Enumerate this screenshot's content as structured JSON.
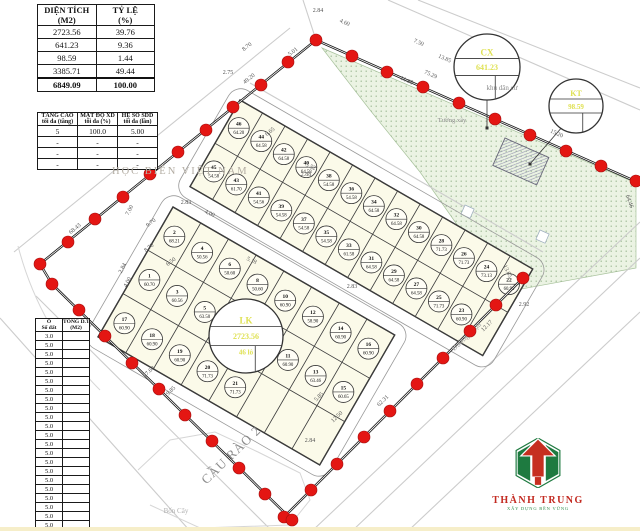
{
  "colors": {
    "dot": "#e41613",
    "dot_edge": "#a50d0d",
    "lot_fill": "#fbfae9",
    "green": "#ebf3e3",
    "green_dot": "#93b289",
    "accent_yellow": "#dfe153",
    "logo_red": "#c62f20",
    "logo_green": "#1e7a40"
  },
  "tables": {
    "area_summary": {
      "headers": [
        [
          "DIỆN TÍCH",
          "(M2)"
        ],
        [
          "TỶ LỆ",
          "(%)"
        ]
      ],
      "rows": [
        [
          "2723.56",
          "39.76"
        ],
        [
          "641.23",
          "9.36"
        ],
        [
          "98.59",
          "1.44"
        ],
        [
          "3385.71",
          "49.44"
        ]
      ],
      "total": [
        "6849.09",
        "100.00"
      ]
    },
    "planning": {
      "headers": [
        [
          "TẦNG CAO",
          "tối đa (tầng)"
        ],
        [
          "MẬT ĐỘ XD",
          "tối đa (%)"
        ],
        [
          "HỆ SỐ SDD",
          "tối đa (lần)"
        ]
      ],
      "rows": [
        [
          "5",
          "100.0",
          "5.00"
        ],
        [
          "-",
          "-",
          "-"
        ],
        [
          "-",
          "-",
          "-"
        ],
        [
          "-",
          "-",
          "-"
        ]
      ]
    },
    "lot_list": {
      "headers": [
        [
          "Ô",
          "Số đất"
        ],
        [
          "TỔNG D.TÍCH",
          "(M2)"
        ]
      ],
      "rows": [
        "3.0",
        "5.0",
        "5.0",
        "5.0",
        "5.0",
        "5.0",
        "5.0",
        "5.0",
        "5.0",
        "5.0",
        "5.0",
        "5.0",
        "5.0",
        "5.0",
        "5.0",
        "5.0",
        "5.0",
        "5.0",
        "5.0",
        "5.0",
        "5.0",
        "5.0"
      ]
    }
  },
  "labels": {
    "campus": "HỌC BIỂN VIỆT NAM"
  },
  "logo": {
    "name": "THÀNH TRUNG",
    "tagline": "XÂY DỰNG BỀN VỮNG"
  },
  "legend_circles": [
    {
      "name": "lk-circle",
      "cx": 246,
      "cy": 336,
      "r": 37,
      "lines": [
        "LK",
        "2723.56",
        "46 lô"
      ],
      "fs": [
        9,
        8,
        7
      ]
    },
    {
      "name": "cx-circle",
      "cx": 487,
      "cy": 67,
      "r": 33,
      "lines": [
        "CX",
        "641.23",
        ""
      ],
      "fs": [
        9,
        8,
        7
      ]
    },
    {
      "name": "kt-circle",
      "cx": 576,
      "cy": 106,
      "r": 27,
      "lines": [
        "KT",
        "98.59",
        ""
      ],
      "fs": [
        8,
        7,
        6
      ]
    }
  ],
  "map": {
    "green_area": [
      [
        322,
        48
      ],
      [
        636,
        183
      ],
      [
        636,
        268
      ],
      [
        505,
        292
      ],
      [
        470,
        243
      ],
      [
        420,
        172
      ],
      [
        370,
        110
      ]
    ],
    "roads": [
      [
        [
          388,
          0
        ],
        [
          640,
          110
        ]
      ],
      [
        [
          418,
          0
        ],
        [
          640,
          88
        ]
      ],
      [
        [
          250,
          83
        ],
        [
          543,
          252
        ]
      ],
      [
        [
          316,
          40
        ],
        [
          303,
          0
        ]
      ],
      [
        [
          312,
          531
        ],
        [
          640,
          222
        ]
      ],
      [
        [
          352,
          531
        ],
        [
          640,
          258
        ]
      ],
      [
        [
          408,
          531
        ],
        [
          640,
          312
        ]
      ],
      [
        [
          36,
          296
        ],
        [
          272,
          531
        ]
      ],
      [
        [
          0,
          318
        ],
        [
          190,
          531
        ]
      ],
      [
        [
          14,
          252
        ],
        [
          290,
          28
        ]
      ]
    ],
    "curves": [
      "M18,246 Q40,330 100,390",
      "M138,470 L170,440 L215,432 L258,452 L300,473 L310,500 L290,525 L200,528 L150,505"
    ],
    "boundary": [
      [
        [
          40,
          264
        ],
        [
          316,
          40
        ]
      ],
      [
        [
          40,
          264
        ],
        [
          52,
          284
        ]
      ],
      [
        [
          316,
          40
        ],
        [
          637,
          182
        ]
      ],
      [
        [
          523,
          278
        ],
        [
          284,
          517
        ]
      ],
      [
        [
          52,
          284
        ],
        [
          292,
          520
        ]
      ]
    ],
    "boundary_dots": [
      [
        40,
        264
      ],
      [
        68,
        242
      ],
      [
        95,
        219
      ],
      [
        123,
        197
      ],
      [
        150,
        174
      ],
      [
        178,
        152
      ],
      [
        206,
        130
      ],
      [
        233,
        107
      ],
      [
        261,
        85
      ],
      [
        288,
        62
      ],
      [
        316,
        40
      ],
      [
        352,
        56
      ],
      [
        387,
        72
      ],
      [
        423,
        87
      ],
      [
        459,
        103
      ],
      [
        495,
        119
      ],
      [
        530,
        135
      ],
      [
        566,
        151
      ],
      [
        601,
        166
      ],
      [
        636,
        181
      ],
      [
        523,
        278
      ],
      [
        496,
        305
      ],
      [
        470,
        331
      ],
      [
        443,
        358
      ],
      [
        417,
        384
      ],
      [
        390,
        411
      ],
      [
        364,
        437
      ],
      [
        337,
        464
      ],
      [
        311,
        490
      ],
      [
        284,
        517
      ],
      [
        52,
        284
      ],
      [
        79,
        310
      ],
      [
        105,
        336
      ],
      [
        132,
        363
      ],
      [
        159,
        389
      ],
      [
        185,
        415
      ],
      [
        212,
        441
      ],
      [
        239,
        468
      ],
      [
        265,
        494
      ],
      [
        292,
        520
      ]
    ],
    "blocks": [
      {
        "x": 240,
        "y": 100,
        "angle": 30,
        "cw": 26,
        "rh": 50,
        "cols": 13,
        "rows": [
          [
            [
              "46",
              "64.20"
            ],
            [
              "44",
              "64.58"
            ],
            [
              "42",
              "64.58"
            ],
            [
              "40",
              "64.58"
            ],
            [
              "38",
              "54.58"
            ],
            [
              "36",
              "54.58"
            ],
            [
              "34",
              "64.58"
            ],
            [
              "32",
              "64.58"
            ],
            [
              "30",
              "64.58"
            ],
            [
              "28",
              "71.73"
            ],
            [
              "26",
              "71.73"
            ],
            [
              "24",
              "73.13"
            ],
            [
              "22",
              "60.90"
            ]
          ],
          [
            [
              "45",
              "54.58"
            ],
            [
              "43",
              "61.70"
            ],
            [
              "41",
              "54.56"
            ],
            [
              "39",
              "54.58"
            ],
            [
              "37",
              "54.58"
            ],
            [
              "35",
              "54.58"
            ],
            [
              "33",
              "61.58"
            ],
            [
              "31",
              "64.58"
            ],
            [
              "29",
              "64.58"
            ],
            [
              "27",
              "64.58"
            ],
            [
              "25",
              "71.73"
            ],
            [
              "23",
              "60.90"
            ]
          ]
        ]
      },
      {
        "x": 173,
        "y": 207,
        "angle": 30,
        "cw": 32,
        "rh": 50,
        "cols": 8,
        "rows": [
          [
            [
              "2",
              "68.21"
            ],
            [
              "4",
              "50.56"
            ],
            [
              "6",
              "50.60"
            ],
            [
              "8",
              "50.60"
            ],
            [
              "10",
              "60.90"
            ],
            [
              "12",
              "58.90"
            ],
            [
              "14",
              "60.90"
            ],
            [
              "16",
              "60.90"
            ]
          ],
          [
            [
              "1",
              "60.70"
            ],
            [
              "3",
              "60.56"
            ],
            [
              "5",
              "63.50"
            ],
            [
              "7",
              "60.50"
            ],
            [
              "9",
              "50.86"
            ],
            [
              "11",
              "60.90"
            ],
            [
              "13",
              "63.46"
            ],
            [
              "15",
              "60.65"
            ]
          ],
          [
            [
              "17",
              "60.90"
            ],
            [
              "18",
              "60.90"
            ],
            [
              "19",
              "60.90"
            ],
            [
              "20",
              "71.73"
            ],
            [
              "21",
              "71.73"
            ]
          ]
        ]
      }
    ],
    "building": {
      "x": 505,
      "y": 138,
      "angle": 24,
      "w": 48,
      "h": 30
    },
    "tree_squares": [
      [
        465,
        205
      ],
      [
        540,
        230
      ]
    ],
    "leaders": [
      [
        [
          487,
          100
        ],
        [
          487,
          128
        ]
      ],
      [
        [
          563,
          126
        ],
        [
          530,
          164
        ]
      ]
    ],
    "dims": [
      [
        "68.43",
        76,
        230,
        -39
      ],
      [
        "49.20",
        250,
        80,
        -39
      ],
      [
        "5.01",
        294,
        53,
        -39
      ],
      [
        "75.29",
        430,
        76,
        24
      ],
      [
        "15.20",
        556,
        135,
        24
      ],
      [
        "64.46",
        628,
        202,
        70
      ],
      [
        "13.65",
        506,
        272,
        65
      ],
      [
        "2.92",
        524,
        306,
        0
      ],
      [
        "12.17",
        488,
        327,
        -45
      ],
      [
        "62.31",
        384,
        402,
        -44
      ],
      [
        "27.60",
        150,
        373,
        -44
      ],
      [
        "9.85",
        172,
        392,
        -44
      ],
      [
        "2.84",
        318,
        12,
        0
      ],
      [
        "4.60",
        344,
        24,
        24
      ],
      [
        "2.75",
        228,
        74,
        0
      ],
      [
        "8.70",
        248,
        48,
        -39
      ],
      [
        "6.65",
        271,
        133,
        -39
      ],
      [
        "5.52",
        310,
        168,
        24
      ],
      [
        "7.50",
        418,
        44,
        24
      ],
      [
        "13.85",
        444,
        60,
        24
      ],
      [
        "11.95",
        406,
        82,
        24
      ],
      [
        "2.83",
        186,
        204,
        0
      ],
      [
        "4.00",
        209,
        215,
        24
      ],
      [
        "9.70",
        152,
        224,
        -39
      ],
      [
        "7.00",
        131,
        211,
        -62
      ],
      [
        "2.61",
        124,
        197,
        -62
      ],
      [
        "8.70",
        150,
        249,
        -39
      ],
      [
        "6.50",
        172,
        263,
        -39
      ],
      [
        "5.18",
        251,
        262,
        24
      ],
      [
        "2.84",
        124,
        269,
        -62
      ],
      [
        "4.00",
        129,
        283,
        -62
      ],
      [
        "2.84",
        310,
        442,
        0
      ],
      [
        "12.50",
        338,
        418,
        -44
      ],
      [
        "5.85",
        320,
        398,
        -44
      ],
      [
        "2.88",
        306,
        176,
        0
      ],
      [
        "2.83",
        352,
        288,
        0
      ]
    ],
    "map_labels": [
      {
        "t": "khu dân cư",
        "x": 502,
        "y": 90,
        "rot": 0,
        "size": 7,
        "color": "#8a8a8a",
        "ls": 0
      },
      {
        "t": "Tường xây",
        "x": 452,
        "y": 122,
        "rot": 0,
        "size": 6.5,
        "color": "#8a8a8a",
        "ls": 0
      },
      {
        "t": "Đường nhựa",
        "x": 468,
        "y": 338,
        "rot": -44,
        "size": 7.5,
        "color": "#9a9a9a",
        "ls": 0
      },
      {
        "t": "Bốn Cây",
        "x": 176,
        "y": 513,
        "rot": 0,
        "size": 7,
        "color": "#b0b0b0",
        "ls": 0
      },
      {
        "t": "CẦU RÀO 2",
        "x": 234,
        "y": 458,
        "rot": -44,
        "size": 13,
        "color": "#8c8c8c",
        "ls": 1
      }
    ]
  }
}
